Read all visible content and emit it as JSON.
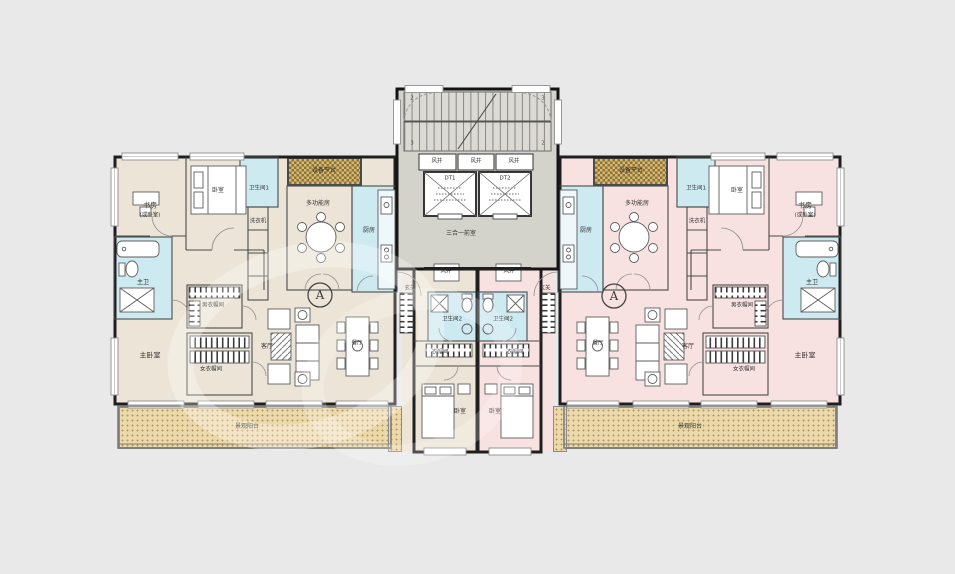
{
  "colors": {
    "background": "#e9e9e9",
    "unit_left_floor": "#ece5d7",
    "unit_right_floor": "#f8e2e1",
    "wet_room": "#cdeaf1",
    "core": "#d3d2cb",
    "balcony": "#ecd9ab",
    "platform_hatch": "#d9b96a",
    "wall": "#1f1f1f"
  },
  "core": {
    "air_shaft": "风井",
    "elevator_1": "DT1",
    "elevator_2": "DT2",
    "lobby": "三合一前室",
    "stair_marks": [
      "2",
      "3",
      "3",
      "2"
    ]
  },
  "unit_left": {
    "marker": "A",
    "study": "书房",
    "study_note": "(或卧室)",
    "bedroom_2": "卧室",
    "bathroom_1": "卫生间1",
    "equipment_platform": "设备平台",
    "multifunction_room": "多功能房",
    "kitchen": "厨房",
    "washer": "洗衣机",
    "master_bathroom": "主卫",
    "master_bedroom": "主卧室",
    "mens_closet": "男衣帽间",
    "womens_closet": "女衣帽间",
    "living_room": "客厅",
    "dining_room": "餐厅",
    "foyer": "玄关",
    "air_shaft": "风井",
    "bathroom_2": "卫生间2",
    "closet": "衣帽间",
    "bedroom_3": "卧室",
    "balcony": "景观阳台"
  },
  "unit_right": {
    "marker": "A",
    "study": "书房",
    "study_note": "(或卧室)",
    "bedroom_2": "卧室",
    "bathroom_1": "卫生间1",
    "equipment_platform": "设备平台",
    "multifunction_room": "多功能房",
    "kitchen": "厨房",
    "washer": "洗衣机",
    "master_bathroom": "主卫",
    "master_bedroom": "主卧室",
    "mens_closet": "男衣帽间",
    "womens_closet": "女衣帽间",
    "living_room": "客厅",
    "dining_room": "餐厅",
    "foyer": "玄关",
    "air_shaft": "风井",
    "bathroom_2": "卫生间2",
    "closet": "衣帽间",
    "bedroom_3": "卧室",
    "balcony": "景观阳台"
  }
}
